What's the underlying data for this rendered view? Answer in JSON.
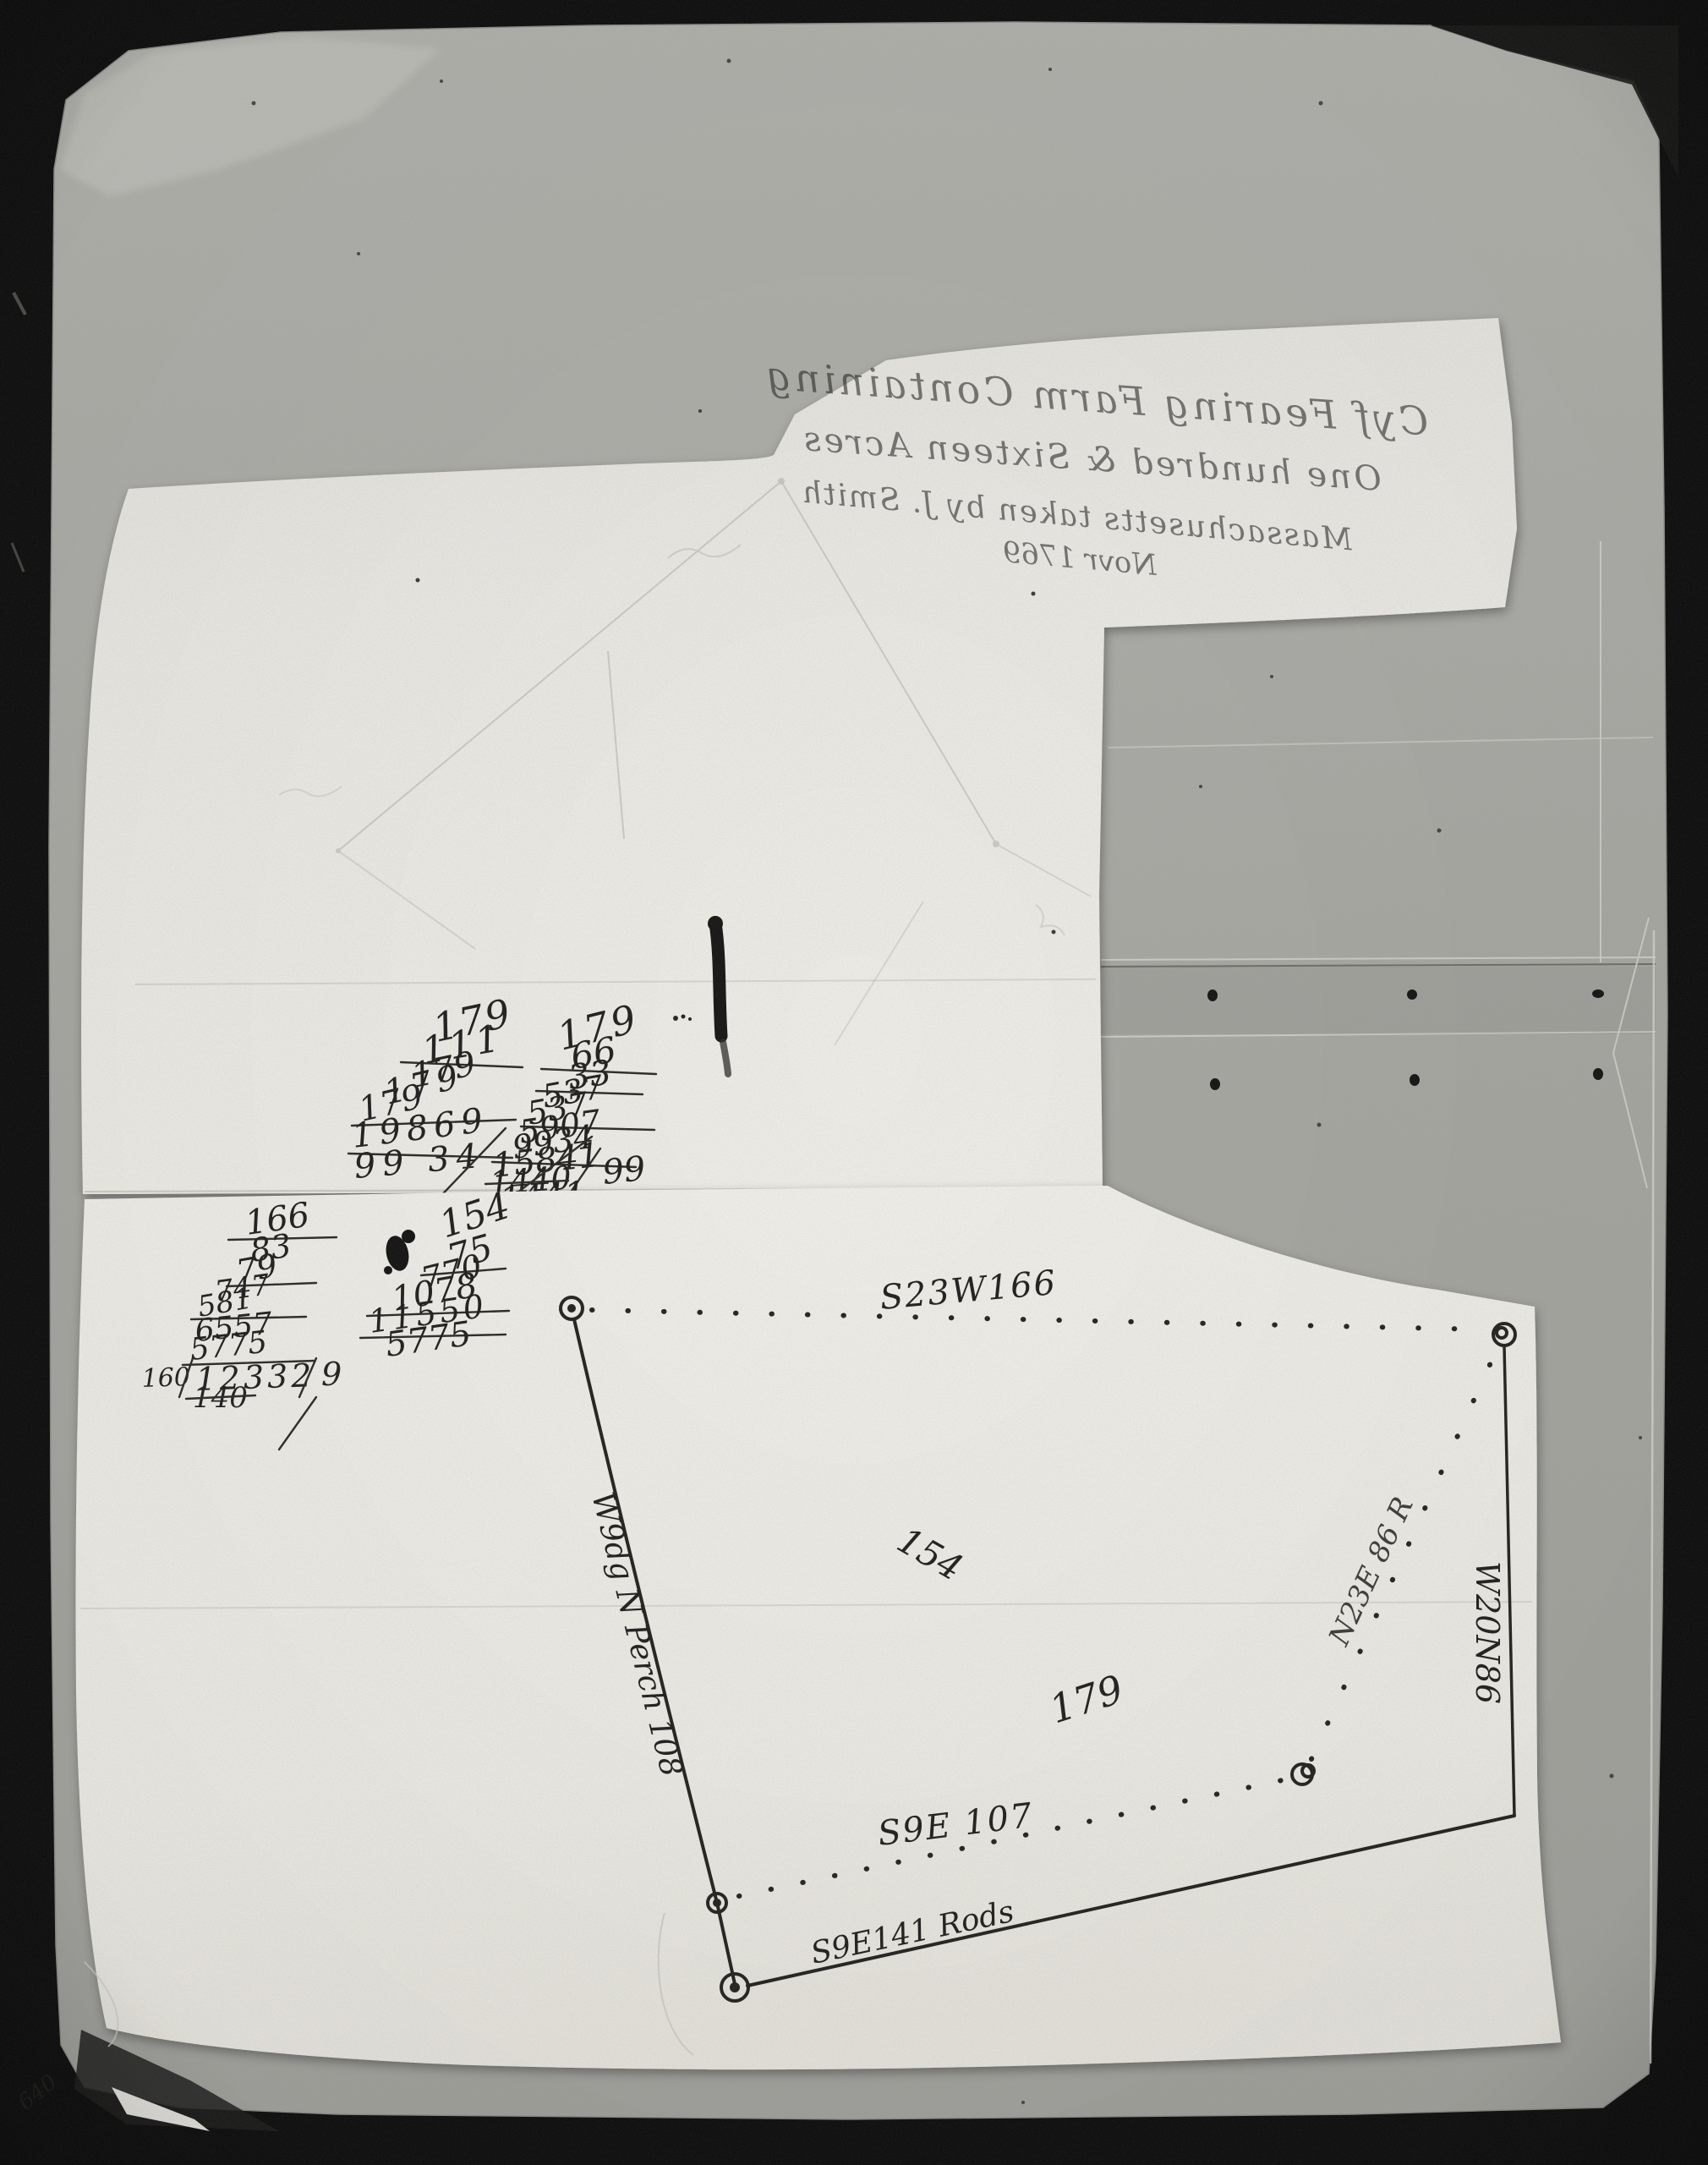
{
  "bleed_through_title": {
    "lines": [
      "Cyf Fearing Farm Containing",
      "One hundred & Sixteen Acres",
      "Massachusetts taken by J. Smith",
      "Novr 1769"
    ]
  },
  "upper_calculation": {
    "left_column": [
      "179",
      "111",
      "179",
      "179",
      "179",
      "19869",
      "99 34"
    ],
    "right_column": [
      "179",
      "66",
      "33",
      "537",
      "537",
      "5907",
      "9934",
      "15841",
      "99",
      "1440",
      "1441"
    ]
  },
  "lower_calculation": {
    "left_column": [
      "166",
      "83",
      "79",
      "747",
      "581",
      "6557",
      "5775",
      "160",
      "12332",
      "9",
      "140"
    ],
    "right_column": [
      "154",
      "75",
      "770",
      "1078",
      "11550",
      "5775"
    ]
  },
  "plat": {
    "top_bearing": "S23W166",
    "inner_bearing": "S9E 107",
    "bottom_bearing": "S9E141 Rods",
    "left_bearing": "W9dg N Perch 108",
    "right_bearing": "W20N86",
    "diagonal_bearing": "N23E 86 R",
    "upper_area_value": "154",
    "lower_area_value": "179"
  },
  "margin_note": "640",
  "colors": {
    "photo_border": "#0c0c0c",
    "backing_paper": "#a9a9a4",
    "sheet_paper": "#efeee9",
    "ink": "#201f1d"
  }
}
